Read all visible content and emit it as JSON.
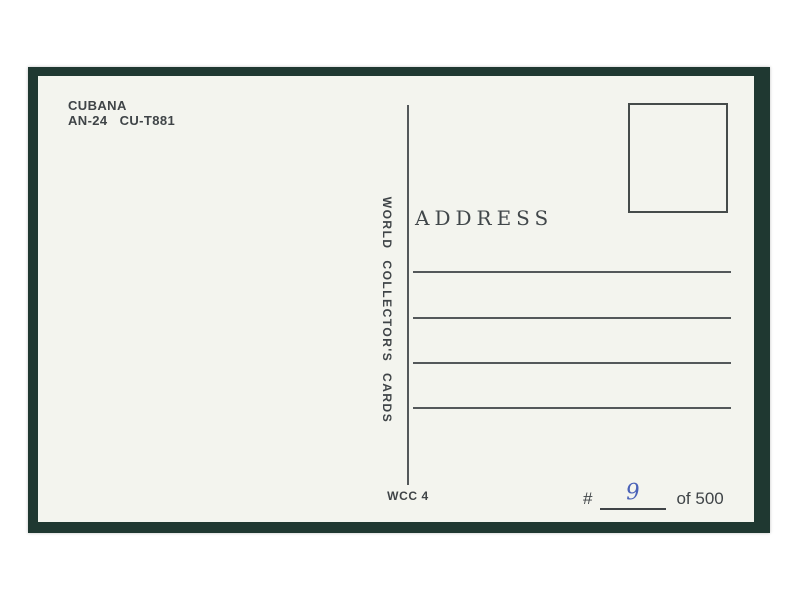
{
  "postcard": {
    "publisher_header": {
      "airline": "CUBANA",
      "aircraft": "AN-24   CU-T881"
    },
    "brand_vertical": "WORLD COLLECTOR'S CARDS",
    "address_label": "ADDRESS",
    "address_lines_count": 4,
    "footer": {
      "code": "WCC 4",
      "serial_prefix": "#",
      "serial_value": "9",
      "serial_suffix": "of 500"
    },
    "colors": {
      "page_background": "#ffffff",
      "frame_border": "#1f3831",
      "card_background": "#f3f4ee",
      "ink": "#3f4447",
      "rule_line": "#53585a",
      "handwriting_blue": "#4a62b8"
    }
  }
}
